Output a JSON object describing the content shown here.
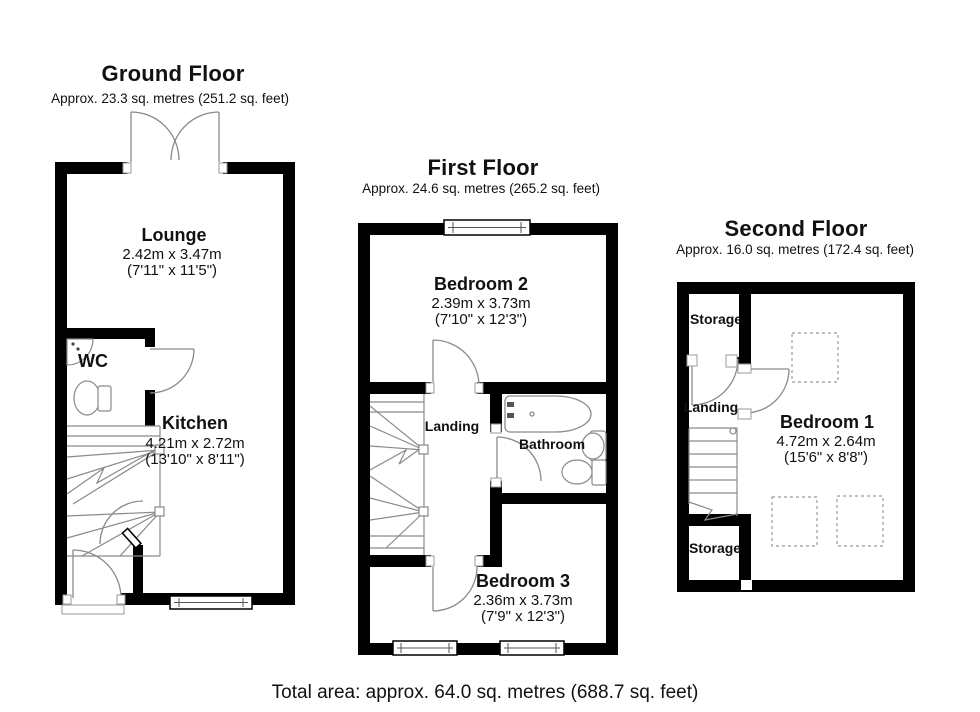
{
  "document_type": "property-floorplan",
  "colors": {
    "wall": "#000000",
    "thin_line": "#8a8a8a",
    "dashed_line": "#9a9a9a",
    "background": "#ffffff",
    "text": "#111111"
  },
  "floors": [
    {
      "id": "ground",
      "title": "Ground Floor",
      "subtitle": "Approx. 23.3 sq. metres (251.2 sq. feet)",
      "rooms": [
        {
          "name": "Lounge",
          "dim_metric": "2.42m x 3.47m",
          "dim_imperial": "(7'11\" x 11'5\")"
        },
        {
          "name": "WC"
        },
        {
          "name": "Kitchen",
          "dim_metric": "4.21m x 2.72m",
          "dim_imperial": "(13'10\" x 8'11\")"
        }
      ]
    },
    {
      "id": "first",
      "title": "First Floor",
      "subtitle": "Approx. 24.6 sq. metres (265.2 sq. feet)",
      "rooms": [
        {
          "name": "Bedroom 2",
          "dim_metric": "2.39m x 3.73m",
          "dim_imperial": "(7'10\" x 12'3\")"
        },
        {
          "name": "Landing"
        },
        {
          "name": "Bathroom"
        },
        {
          "name": "Bedroom 3",
          "dim_metric": "2.36m x 3.73m",
          "dim_imperial": "(7'9\" x 12'3\")"
        }
      ]
    },
    {
      "id": "second",
      "title": "Second Floor",
      "subtitle": "Approx. 16.0 sq. metres (172.4 sq. feet)",
      "rooms": [
        {
          "name": "Storage"
        },
        {
          "name": "Landing"
        },
        {
          "name": "Bedroom 1",
          "dim_metric": "4.72m x 2.64m",
          "dim_imperial": "(15'6\" x 8'8\")"
        },
        {
          "name": "Storage"
        }
      ]
    }
  ],
  "footer": {
    "total_area": "Total area: approx. 64.0 sq. metres (688.7 sq. feet)"
  }
}
